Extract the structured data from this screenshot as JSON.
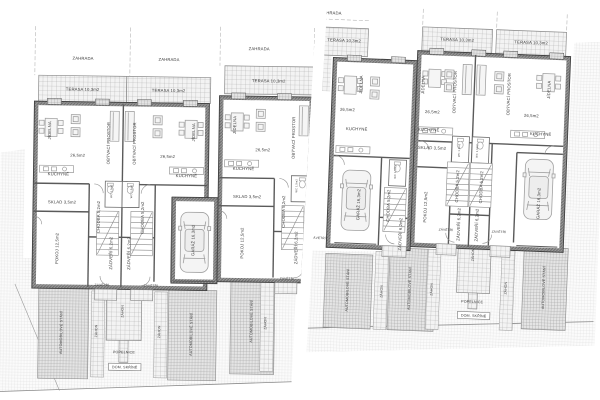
{
  "drawing": {
    "type": "architectural floor plan, two site plans of row houses",
    "language": "Czech",
    "palette": {
      "paper": "#ffffff",
      "wall_dark": "#8f8f8f",
      "wall_outline": "#3f3f3f",
      "thin_line": "#8a8a8a",
      "terrace_hatch": "#b0b0b0",
      "site_hatch": "#d8d8d8",
      "parking_hatch": "#9a9a9a",
      "text": "#3a3a3a"
    }
  },
  "labels": {
    "zahrada": "ZAHRADA",
    "terasa": "TERASA 10,3m2",
    "jidelna": "JÍDELNA",
    "obyvaci": "OBÝVACÍ PROSTOR",
    "area_living": "26,5m2",
    "kuchyne": "KUCHYNĚ",
    "sklad": "SKLAD 3,5m2",
    "chodba": "CHODBA 5,2m2",
    "wc": "WC 1,5m2",
    "pokoj": "POKOJ 12,5m2",
    "zadveri": "ZÁDVEŘÍ 6,2m2",
    "garaz": "GARÁŽ 16,3m2",
    "zavetri": "ZÁVĚTŘÍ",
    "zahon": "ZÁHON",
    "stani": "AUTOMOBILOVÉ STÁNÍ",
    "popelnice": "POPELNICE",
    "dom_skrine": "DOM. SKŘÍNĚ"
  },
  "placements": {
    "left": [
      {
        "k": "zahrada",
        "x": 67,
        "y": 41
      },
      {
        "k": "zahrada",
        "x": 153,
        "y": 41
      },
      {
        "k": "zahrada",
        "x": 243,
        "y": 29
      },
      {
        "k": "terasa",
        "x": 67,
        "y": 72
      },
      {
        "k": "terasa",
        "x": 153,
        "y": 72
      },
      {
        "k": "terasa",
        "x": 253,
        "y": 61
      },
      {
        "k": "jidelna",
        "x": 36,
        "y": 112,
        "r": 1
      },
      {
        "k": "obyvaci",
        "x": 95,
        "y": 124,
        "r": 1
      },
      {
        "k": "area_living",
        "x": 63,
        "y": 138
      },
      {
        "k": "kuchyne",
        "x": 44,
        "y": 157
      },
      {
        "k": "sklad",
        "x": 48,
        "y": 185
      },
      {
        "k": "pokoj",
        "x": 45,
        "y": 230,
        "r": 1
      },
      {
        "k": "chodba",
        "x": 86,
        "y": 198,
        "r": 1
      },
      {
        "k": "zadveri",
        "x": 99,
        "y": 234,
        "r": 1
      },
      {
        "k": "wc",
        "x": 98,
        "y": 172,
        "r": 1,
        "s": 2.6
      },
      {
        "k": "obyvaci",
        "x": 121,
        "y": 124,
        "r": 1
      },
      {
        "k": "jidelna",
        "x": 180,
        "y": 112,
        "r": 1
      },
      {
        "k": "area_living",
        "x": 153,
        "y": 138
      },
      {
        "k": "kuchyne",
        "x": 172,
        "y": 157
      },
      {
        "k": "chodba",
        "x": 130,
        "y": 198,
        "r": 1
      },
      {
        "k": "zadveri",
        "x": 117,
        "y": 234,
        "r": 1
      },
      {
        "k": "wc",
        "x": 118,
        "y": 172,
        "r": 1,
        "s": 2.6
      },
      {
        "k": "garaz",
        "x": 181,
        "y": 220,
        "r": 1
      },
      {
        "k": "jidelna",
        "x": 221,
        "y": 104,
        "r": 1
      },
      {
        "k": "obyvaci",
        "x": 280,
        "y": 116,
        "r": 1
      },
      {
        "k": "area_living",
        "x": 248,
        "y": 130
      },
      {
        "k": "kuchyne",
        "x": 229,
        "y": 149
      },
      {
        "k": "sklad",
        "x": 233,
        "y": 177
      },
      {
        "k": "pokoj",
        "x": 230,
        "y": 222,
        "r": 1
      },
      {
        "k": "chodba",
        "x": 271,
        "y": 190,
        "r": 1
      },
      {
        "k": "zadveri",
        "x": 284,
        "y": 226,
        "r": 1
      },
      {
        "k": "wc",
        "x": 283,
        "y": 164,
        "r": 1,
        "s": 2.6
      },
      {
        "k": "zavetri",
        "x": 89,
        "y": 267,
        "s": 3.2
      },
      {
        "k": "zavetri",
        "x": 138,
        "y": 267,
        "s": 3.2
      },
      {
        "k": "zavetri",
        "x": 274,
        "y": 258,
        "s": 3.2
      },
      {
        "k": "stani",
        "x": 50,
        "y": 314,
        "r": 1,
        "s": 3.6
      },
      {
        "k": "stani",
        "x": 180,
        "y": 314,
        "r": 1,
        "s": 3.6
      },
      {
        "k": "stani",
        "x": 240,
        "y": 300,
        "r": 1,
        "s": 3.6
      },
      {
        "k": "zahon",
        "x": 85,
        "y": 312,
        "r": 1,
        "s": 3.4
      },
      {
        "k": "zahon",
        "x": 148,
        "y": 312,
        "r": 1,
        "s": 3.4
      },
      {
        "k": "zahon",
        "x": 254,
        "y": 302,
        "r": 1,
        "s": 3.4
      },
      {
        "k": "zahon",
        "x": 111,
        "y": 292,
        "r": 1,
        "s": 3.4
      },
      {
        "k": "popelnice",
        "x": 112,
        "y": 334,
        "s": 3.6
      },
      {
        "k": "dom_skrine",
        "x": 113,
        "y": 349,
        "s": 3.6,
        "b": 1
      }
    ],
    "right": [
      {
        "k": "zahrada",
        "x": 24,
        "y": 9
      },
      {
        "k": "terasa",
        "x": 38,
        "y": 36
      },
      {
        "k": "terasa",
        "x": 151,
        "y": 31
      },
      {
        "k": "terasa",
        "x": 225,
        "y": 31
      },
      {
        "k": "jidelna",
        "x": 58,
        "y": 78,
        "r": 1
      },
      {
        "k": "area_living",
        "x": 44,
        "y": 105
      },
      {
        "k": "kuchyne",
        "x": 54,
        "y": 124
      },
      {
        "k": "garaz",
        "x": 60,
        "y": 198,
        "r": 1
      },
      {
        "k": "chodba",
        "x": 90,
        "y": 198,
        "r": 1
      },
      {
        "k": "zadveri",
        "x": 103,
        "y": 226,
        "r": 1
      },
      {
        "k": "wc",
        "x": 95,
        "y": 164,
        "r": 1,
        "s": 2.6
      },
      {
        "k": "jidelna",
        "x": 120,
        "y": 76,
        "r": 1
      },
      {
        "k": "obyvaci",
        "x": 152,
        "y": 82,
        "r": 1
      },
      {
        "k": "area_living",
        "x": 129,
        "y": 104
      },
      {
        "k": "kuchyne",
        "x": 126,
        "y": 122
      },
      {
        "k": "sklad",
        "x": 130,
        "y": 140
      },
      {
        "k": "pokoj",
        "x": 127,
        "y": 198,
        "r": 1
      },
      {
        "k": "chodba",
        "x": 158,
        "y": 176,
        "r": 1
      },
      {
        "k": "zadveri",
        "x": 161,
        "y": 214,
        "r": 1
      },
      {
        "k": "wc",
        "x": 158,
        "y": 140,
        "r": 1,
        "s": 2.6
      },
      {
        "k": "obyvaci",
        "x": 206,
        "y": 82,
        "r": 1
      },
      {
        "k": "jidelna",
        "x": 246,
        "y": 76,
        "r": 1
      },
      {
        "k": "area_living",
        "x": 228,
        "y": 104
      },
      {
        "k": "kuchyne",
        "x": 238,
        "y": 122
      },
      {
        "k": "chodba",
        "x": 182,
        "y": 176,
        "r": 1
      },
      {
        "k": "zadveri",
        "x": 179,
        "y": 214,
        "r": 1
      },
      {
        "k": "wc",
        "x": 176,
        "y": 140,
        "r": 1,
        "s": 2.6
      },
      {
        "k": "garaz",
        "x": 240,
        "y": 190,
        "r": 1
      },
      {
        "k": "zavetri",
        "x": 20,
        "y": 234,
        "s": 3.2
      },
      {
        "k": "zavetri",
        "x": 147,
        "y": 221,
        "s": 3.2
      },
      {
        "k": "zavetri",
        "x": 200,
        "y": 221,
        "s": 3.2
      },
      {
        "k": "stani",
        "x": 52,
        "y": 284,
        "r": 1,
        "s": 3.6
      },
      {
        "k": "stani",
        "x": 114,
        "y": 280,
        "r": 1,
        "s": 3.6
      },
      {
        "k": "stani",
        "x": 248,
        "y": 274,
        "r": 1,
        "s": 3.6
      },
      {
        "k": "zahon",
        "x": 86,
        "y": 284,
        "r": 1,
        "s": 3.4
      },
      {
        "k": "zahon",
        "x": 136,
        "y": 280,
        "r": 1,
        "s": 3.4
      },
      {
        "k": "zahon",
        "x": 210,
        "y": 276,
        "r": 1,
        "s": 3.4
      },
      {
        "k": "zahon",
        "x": 176,
        "y": 244,
        "r": 1,
        "s": 3.4
      },
      {
        "k": "popelnice",
        "x": 176,
        "y": 292,
        "s": 3.6
      },
      {
        "k": "dom_skrine",
        "x": 178,
        "y": 306,
        "s": 3.6,
        "b": 1
      }
    ]
  }
}
